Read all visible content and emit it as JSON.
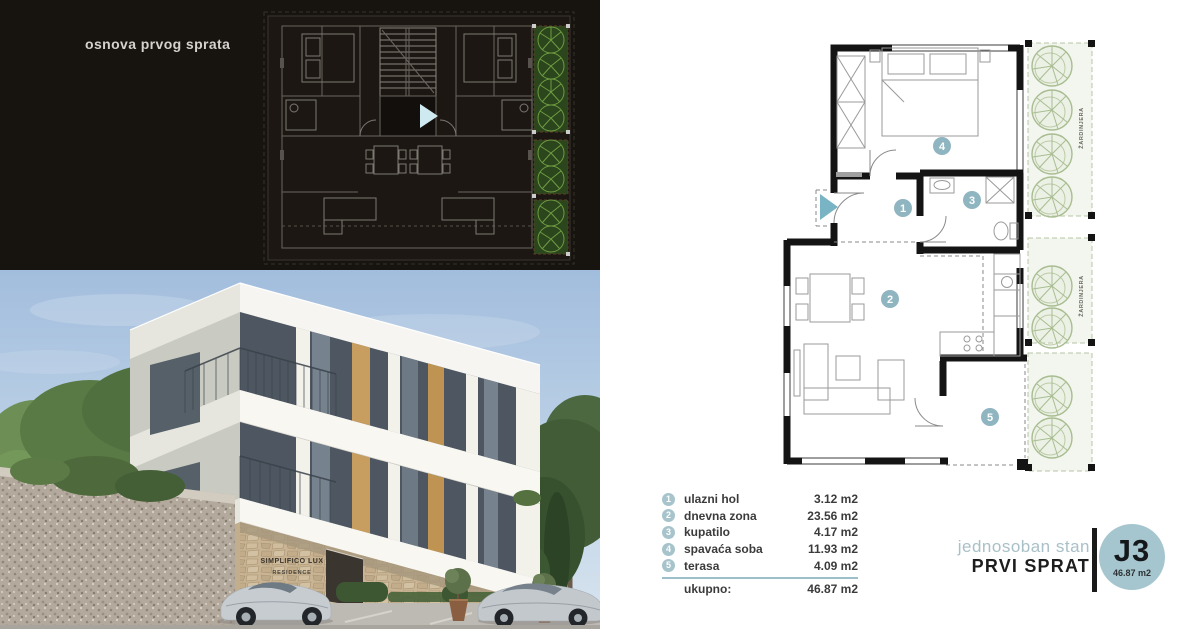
{
  "dark_panel": {
    "title": "osnova prvog sprata"
  },
  "photo": {
    "sign_line1": "SIMPLIFICO LUX",
    "sign_line2": "RESIDENCE"
  },
  "plan": {
    "planter_label": "ŽARDINJERA",
    "markers": [
      "1",
      "2",
      "3",
      "4",
      "5"
    ]
  },
  "legend": {
    "rows": [
      {
        "num": "1",
        "label": "ulazni hol",
        "area": "3.12 m2"
      },
      {
        "num": "2",
        "label": "dnevna zona",
        "area": "23.56 m2"
      },
      {
        "num": "3",
        "label": "kupatilo",
        "area": "4.17 m2"
      },
      {
        "num": "4",
        "label": "spavaća soba",
        "area": "11.93 m2"
      },
      {
        "num": "5",
        "label": "terasa",
        "area": "4.09 m2"
      }
    ],
    "total_label": "ukupno:",
    "total_value": "46.87 m2"
  },
  "title_block": {
    "subtitle": "jednosoban stan",
    "floor": "PRVI SPRAT",
    "unit": "J3",
    "unit_area": "46.87 m2"
  },
  "colors": {
    "accent_divider": "#9cc0ca",
    "room_marker": "#8fb5c1",
    "planter_green": "#a9bd92",
    "dark_background": "#17130f",
    "unit_badge": "#a5c6ce"
  }
}
